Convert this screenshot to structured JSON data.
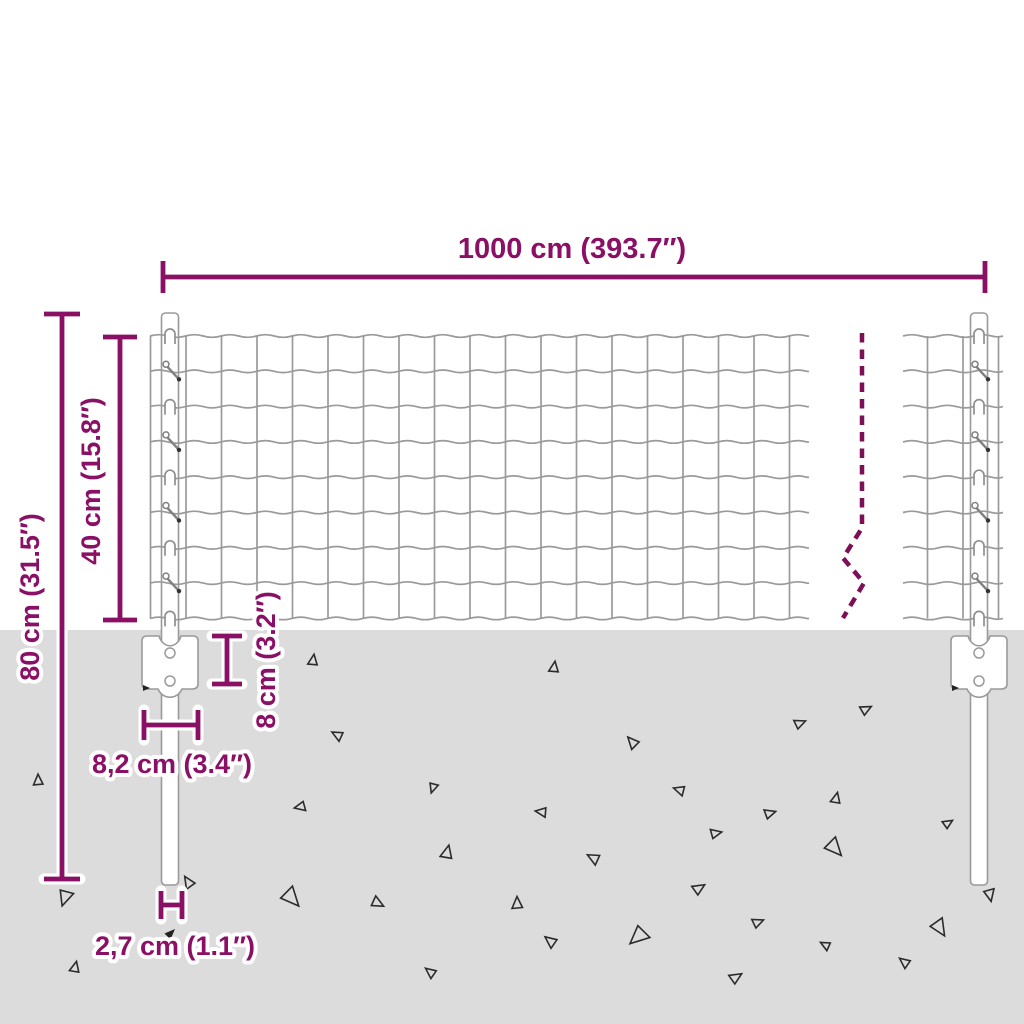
{
  "labels": {
    "total_width": "1000 cm (393.7″)",
    "post_height": "80 cm (31.5″)",
    "mesh_height": "40 cm (15.8″)",
    "anchor_depth": "8 cm (3.2″)",
    "anchor_width": "8,2 cm (3.4″)",
    "post_thickness": "2,7 cm (1.1″)"
  },
  "colors": {
    "dimension": "#8a1066",
    "break_line": "#7c0f56",
    "wire": "#9a9a9a",
    "post_outline": "#9a9a9a",
    "post_fill": "#ffffff",
    "ground": "#dcdcdc",
    "triangle": "#2b2b2b",
    "background": "#ffffff"
  },
  "geometry": {
    "ground_top": 630,
    "mesh": {
      "row_count": 9,
      "top_y": 336,
      "row_spacing": 35.3,
      "left_panel": {
        "x_start": 150,
        "x_end": 809,
        "wire_x_start": 150.5,
        "wire_spacing": 35.5,
        "wire_count": 19
      },
      "right_panel": {
        "x_start": 903,
        "x_end": 1003,
        "wire_xs": [
          927.5,
          963,
          998.5
        ]
      }
    },
    "posts": {
      "left": {
        "cx": 170,
        "top": 313,
        "bottom": 885,
        "width": 17
      },
      "right": {
        "cx": 979,
        "top": 313,
        "bottom": 885,
        "width": 17
      }
    },
    "plates": {
      "top": 636,
      "bottom": 689,
      "half_width": 28,
      "hole_r": 5,
      "hole_y1": 653,
      "hole_y2": 681
    },
    "break_line": {
      "points": [
        [
          862,
          333
        ],
        [
          862,
          528
        ],
        [
          843,
          558
        ],
        [
          864,
          583
        ],
        [
          843,
          618
        ]
      ],
      "dash": "9.5 7"
    },
    "dimensions": {
      "total_width": {
        "type": "h",
        "y": 277,
        "x1": 163,
        "x2": 985,
        "cap": 16
      },
      "post_height": {
        "type": "v",
        "x": 62,
        "y1": 314,
        "y2": 879,
        "cap": 18
      },
      "mesh_height": {
        "type": "v",
        "x": 120,
        "y1": 337,
        "y2": 620,
        "cap": 17
      },
      "anchor_depth": {
        "type": "v",
        "x": 227,
        "y1": 636,
        "y2": 684,
        "cap": 15
      },
      "anchor_width": {
        "type": "h",
        "y": 725,
        "x1": 144,
        "x2": 198,
        "cap": 15
      },
      "post_thickness": {
        "type": "h",
        "y": 905,
        "x1": 161,
        "x2": 182,
        "cap": 14
      }
    },
    "triangles": [
      [
        38,
        780,
        9,
        0
      ],
      [
        65,
        898,
        13,
        200
      ],
      [
        75,
        967,
        9,
        15
      ],
      [
        188,
        882,
        10,
        330
      ],
      [
        292,
        898,
        16,
        140
      ],
      [
        300,
        807,
        9,
        260
      ],
      [
        313,
        660,
        9,
        10
      ],
      [
        337,
        735,
        9,
        300
      ],
      [
        378,
        903,
        10,
        120
      ],
      [
        430,
        972,
        9,
        310
      ],
      [
        433,
        788,
        8,
        200
      ],
      [
        447,
        852,
        11,
        15
      ],
      [
        517,
        903,
        10,
        0
      ],
      [
        541,
        812,
        9,
        280
      ],
      [
        550,
        941,
        10,
        310
      ],
      [
        554,
        667,
        9,
        10
      ],
      [
        593,
        858,
        10,
        300
      ],
      [
        632,
        742,
        10,
        320
      ],
      [
        638,
        937,
        16,
        230
      ],
      [
        679,
        790,
        9,
        290
      ],
      [
        699,
        888,
        10,
        60
      ],
      [
        716,
        833,
        9,
        80
      ],
      [
        736,
        977,
        10,
        60
      ],
      [
        758,
        922,
        9,
        70
      ],
      [
        770,
        813,
        9,
        75
      ],
      [
        800,
        723,
        9,
        70
      ],
      [
        825,
        945,
        8,
        300
      ],
      [
        835,
        848,
        15,
        140
      ],
      [
        836,
        798,
        9,
        15
      ],
      [
        866,
        709,
        9,
        65
      ],
      [
        904,
        962,
        9,
        310
      ],
      [
        940,
        928,
        14,
        150
      ],
      [
        948,
        823,
        8,
        60
      ],
      [
        990,
        895,
        10,
        170
      ]
    ]
  }
}
